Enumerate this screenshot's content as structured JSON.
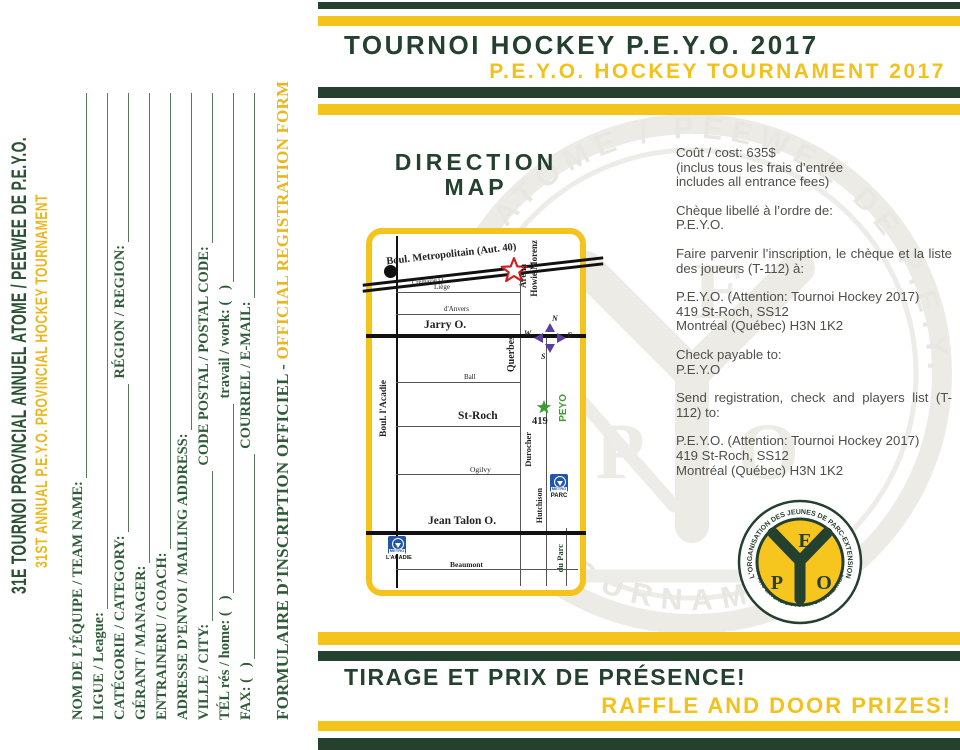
{
  "colors": {
    "dark_green": "#24402f",
    "yellow": "#f5c41c",
    "form_green": "#2f5c38",
    "gold_text": "#eab71a",
    "body_gray": "#4e4f4a",
    "metro_blue": "#2356a8",
    "compass_purple": "#5b3e9e",
    "star_red": "#cf2020",
    "star_green": "#3f9c35"
  },
  "left_page": {
    "headline_fr": "31E TOURNOI PROVNCIAL ANNUEL ATOME / PEEWEE DE P.E.Y.O.",
    "headline_en": "31ST ANNUAL P.E.Y.O. PROVINCIAL HOCKEY TOURNAMENT",
    "form": {
      "rows": [
        {
          "label": "NOM DE L’ÉQUIPE / TEAM NAME:"
        },
        {
          "label": "LIGUE / League:"
        },
        {
          "label": "CATÉGORIE  /  CATEGORY:",
          "label2": "RÉGION  /  REGION:"
        },
        {
          "label": "GÉRANT / MANAGER:"
        },
        {
          "label": "ENTRAINERU / COACH:"
        },
        {
          "label": "ADRESSE D’ENVOI / MAILING ADDRESS:"
        },
        {
          "label": "VILLE / CITY:",
          "label2": "CODE POSTAL / POSTAL CODE:"
        },
        {
          "label": "TÉL rés / home: (   )",
          "label2": "travail / work: (   )"
        },
        {
          "label": "FAX: (   )",
          "label2": "COURRIEL / E-MAIL:"
        }
      ],
      "footer_fr": "FORMULAIRE D’INSCRIPTION OFFICIEL - ",
      "footer_en": "OFFICIAL REGISTRATION FORM"
    }
  },
  "header": {
    "title_fr": "TOURNOI HOCKEY P.E.Y.O. 2017",
    "title_en": "P.E.Y.O. HOCKEY TOURNAMENT 2017"
  },
  "map": {
    "title_line1": "DIRECTION",
    "title_line2": "MAP",
    "metropolitain": "Boul. Metropolitain (Aut. 40)",
    "cremazie": "Crémazie O.",
    "liege": "Liège",
    "danvers": "d'Anvers",
    "jarry": "Jarry O.",
    "ball": "Ball",
    "stroch": "St-Roch",
    "ogilvy": "Ogilvy",
    "jeantalon": "Jean Talon O.",
    "beaumont": "Beaumont",
    "acadie": "Boul. l'Acadie",
    "querbes": "Querbes",
    "durocher": "Durocher",
    "hutchison": "Hutchison",
    "duparc": "du Parc",
    "arena_line1": "Aréna",
    "arena_line2": "Howie Morenz",
    "address_num": "419",
    "peyo": "PEYO",
    "metro_word": "METRO",
    "metro_parc": "PARC",
    "metro_acadie": "L'ACADIE",
    "compass": {
      "n": "N",
      "w": "W",
      "s": "S",
      "e": "E"
    }
  },
  "info": {
    "p1": "Coût / cost: 635$\n(inclus tous les frais d’entrée\nincludes all entrance fees)",
    "p2": "Chèque libellé à l’ordre de:\nP.E.Y.O.",
    "p3": "Faire parvenir l’inscription, le chèque et la liste des joueurs (T-112) à:",
    "p4": "P.E.Y.O. (Attention: Tournoi Hockey 2017)\n419 St-Roch, SS12\nMontréal (Québec) H3N 1K2",
    "p5": "Check payable to:\nP.E.Y.O",
    "p6": "Send registration, check and players list (T-112) to:",
    "p7": "P.E.Y.O. (Attention: Tournoi Hockey 2017)\n419 St-Roch, SS12\nMontréal (Québec) H3N 1K2"
  },
  "footer": {
    "title_fr": "TIRAGE ET PRIX DE PRÉSENCE!",
    "title_en": "RAFFLE AND DOOR PRIZES!"
  },
  "logo": {
    "arc_top": "L'ORGANISATION DES JEUNES DE PARC-EXTENSION",
    "arc_bottom": "PARC-EXTENSION YOUTH ORGANIZATION",
    "letter_e": "E",
    "letter_p": "P",
    "letter_o": "O"
  },
  "watermark": {
    "arc_top": "TOURNOI ATOME / PEEWEE DE P.E.Y.O.",
    "arc_bottom": "TOURNAMENT"
  }
}
